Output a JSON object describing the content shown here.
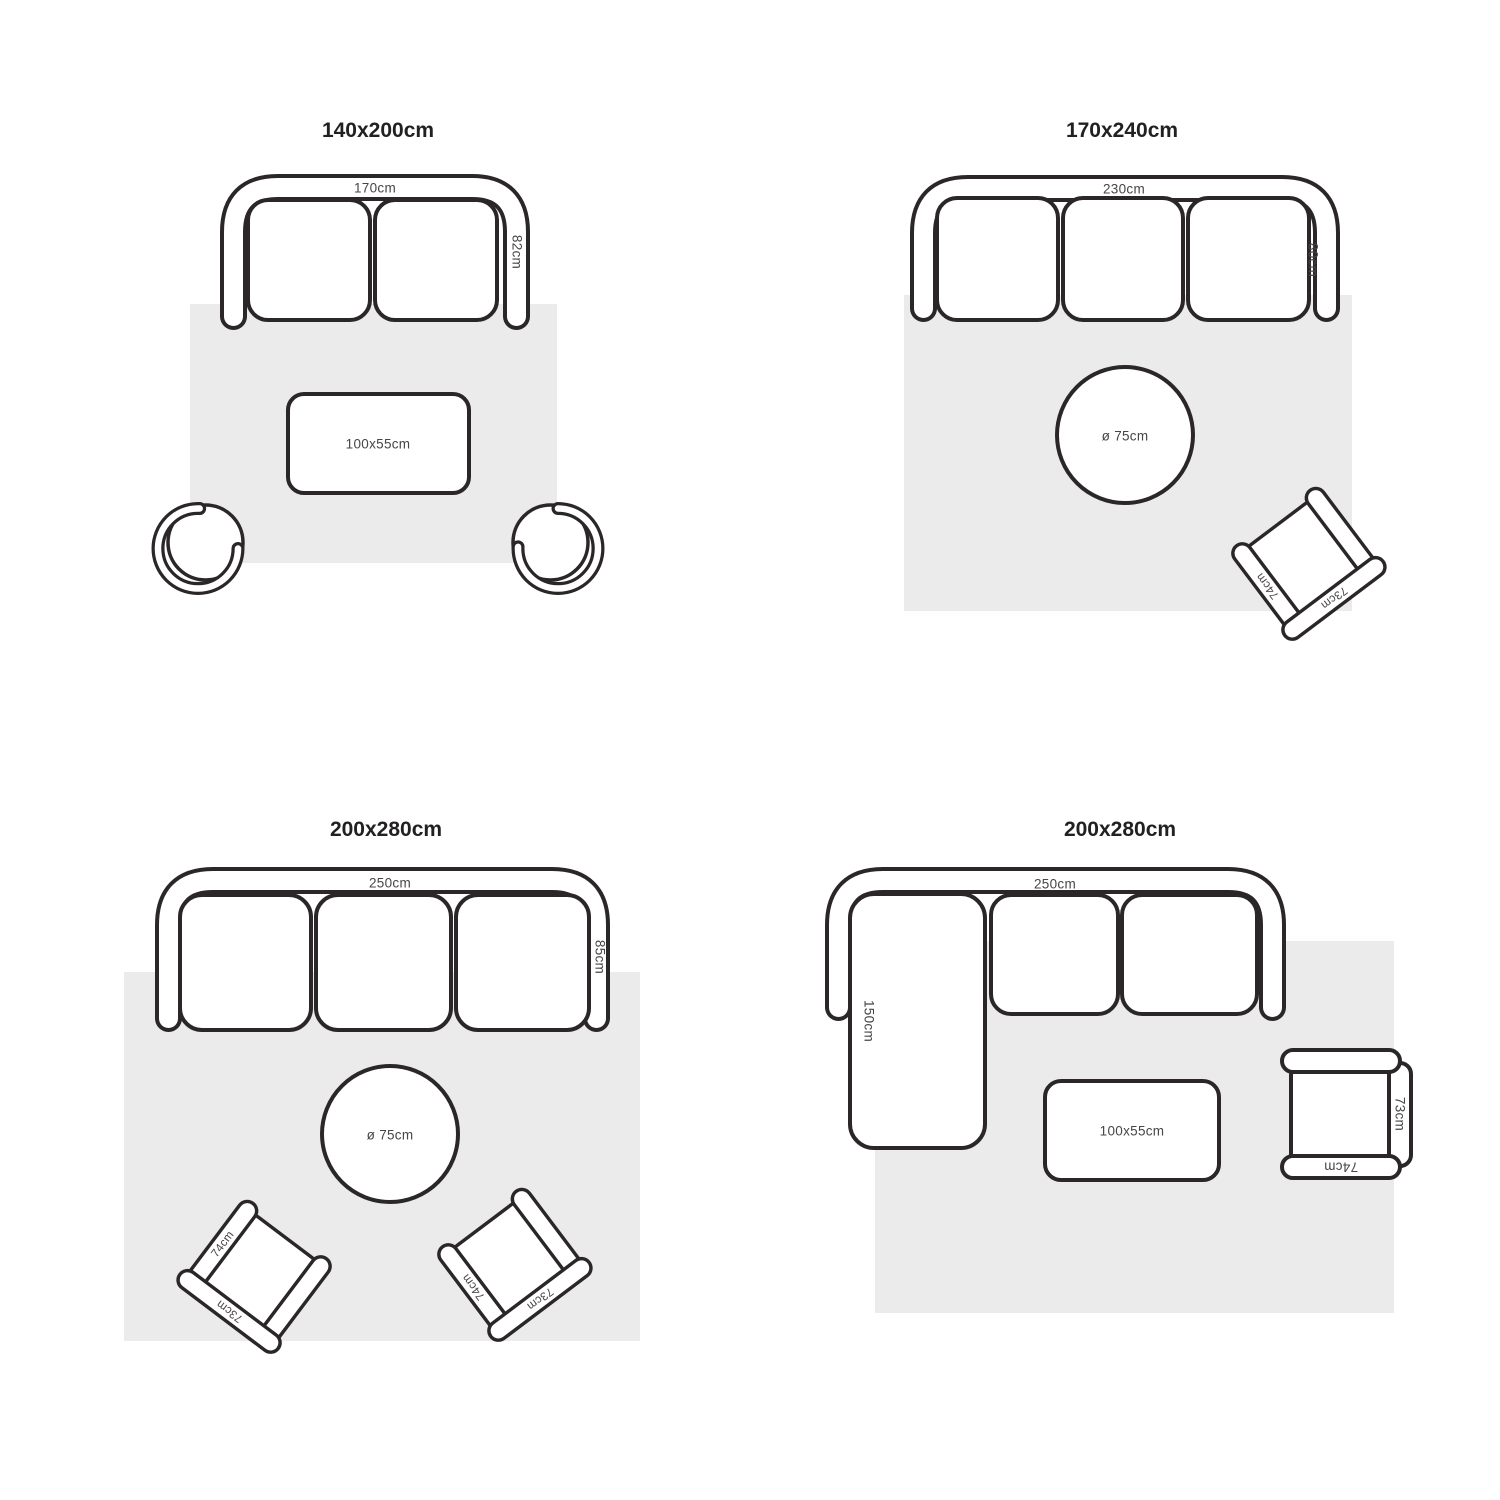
{
  "colors": {
    "line": "#2b2728",
    "rug": "#ebebeb",
    "label": "#474546",
    "title": "#232021",
    "background": "#ffffff"
  },
  "panels": [
    {
      "title": "140x200cm",
      "sofa": {
        "width": "170cm",
        "depth": "82cm",
        "seats": 2
      },
      "coffee_table": {
        "size": "100x55cm"
      },
      "round_chairs": 2
    },
    {
      "title": "170x240cm",
      "sofa": {
        "width": "230cm",
        "depth": "80cm",
        "seats": 3
      },
      "round_table": {
        "diameter": "ø 75cm"
      },
      "armchair": {
        "width": "73cm",
        "depth": "74cm"
      }
    },
    {
      "title": "200x280cm",
      "sofa": {
        "width": "250cm",
        "depth": "85cm",
        "seats": 3
      },
      "round_table": {
        "diameter": "ø 75cm"
      },
      "armchair_left": {
        "width": "73cm",
        "depth": "74cm"
      },
      "armchair_right": {
        "width": "73cm",
        "depth": "74cm"
      }
    },
    {
      "title": "200x280cm",
      "sofa": {
        "width": "250cm",
        "chaise": "150cm",
        "seats": 2
      },
      "coffee_table": {
        "size": "100x55cm"
      },
      "armchair": {
        "width": "73cm",
        "depth": "74cm"
      }
    }
  ]
}
